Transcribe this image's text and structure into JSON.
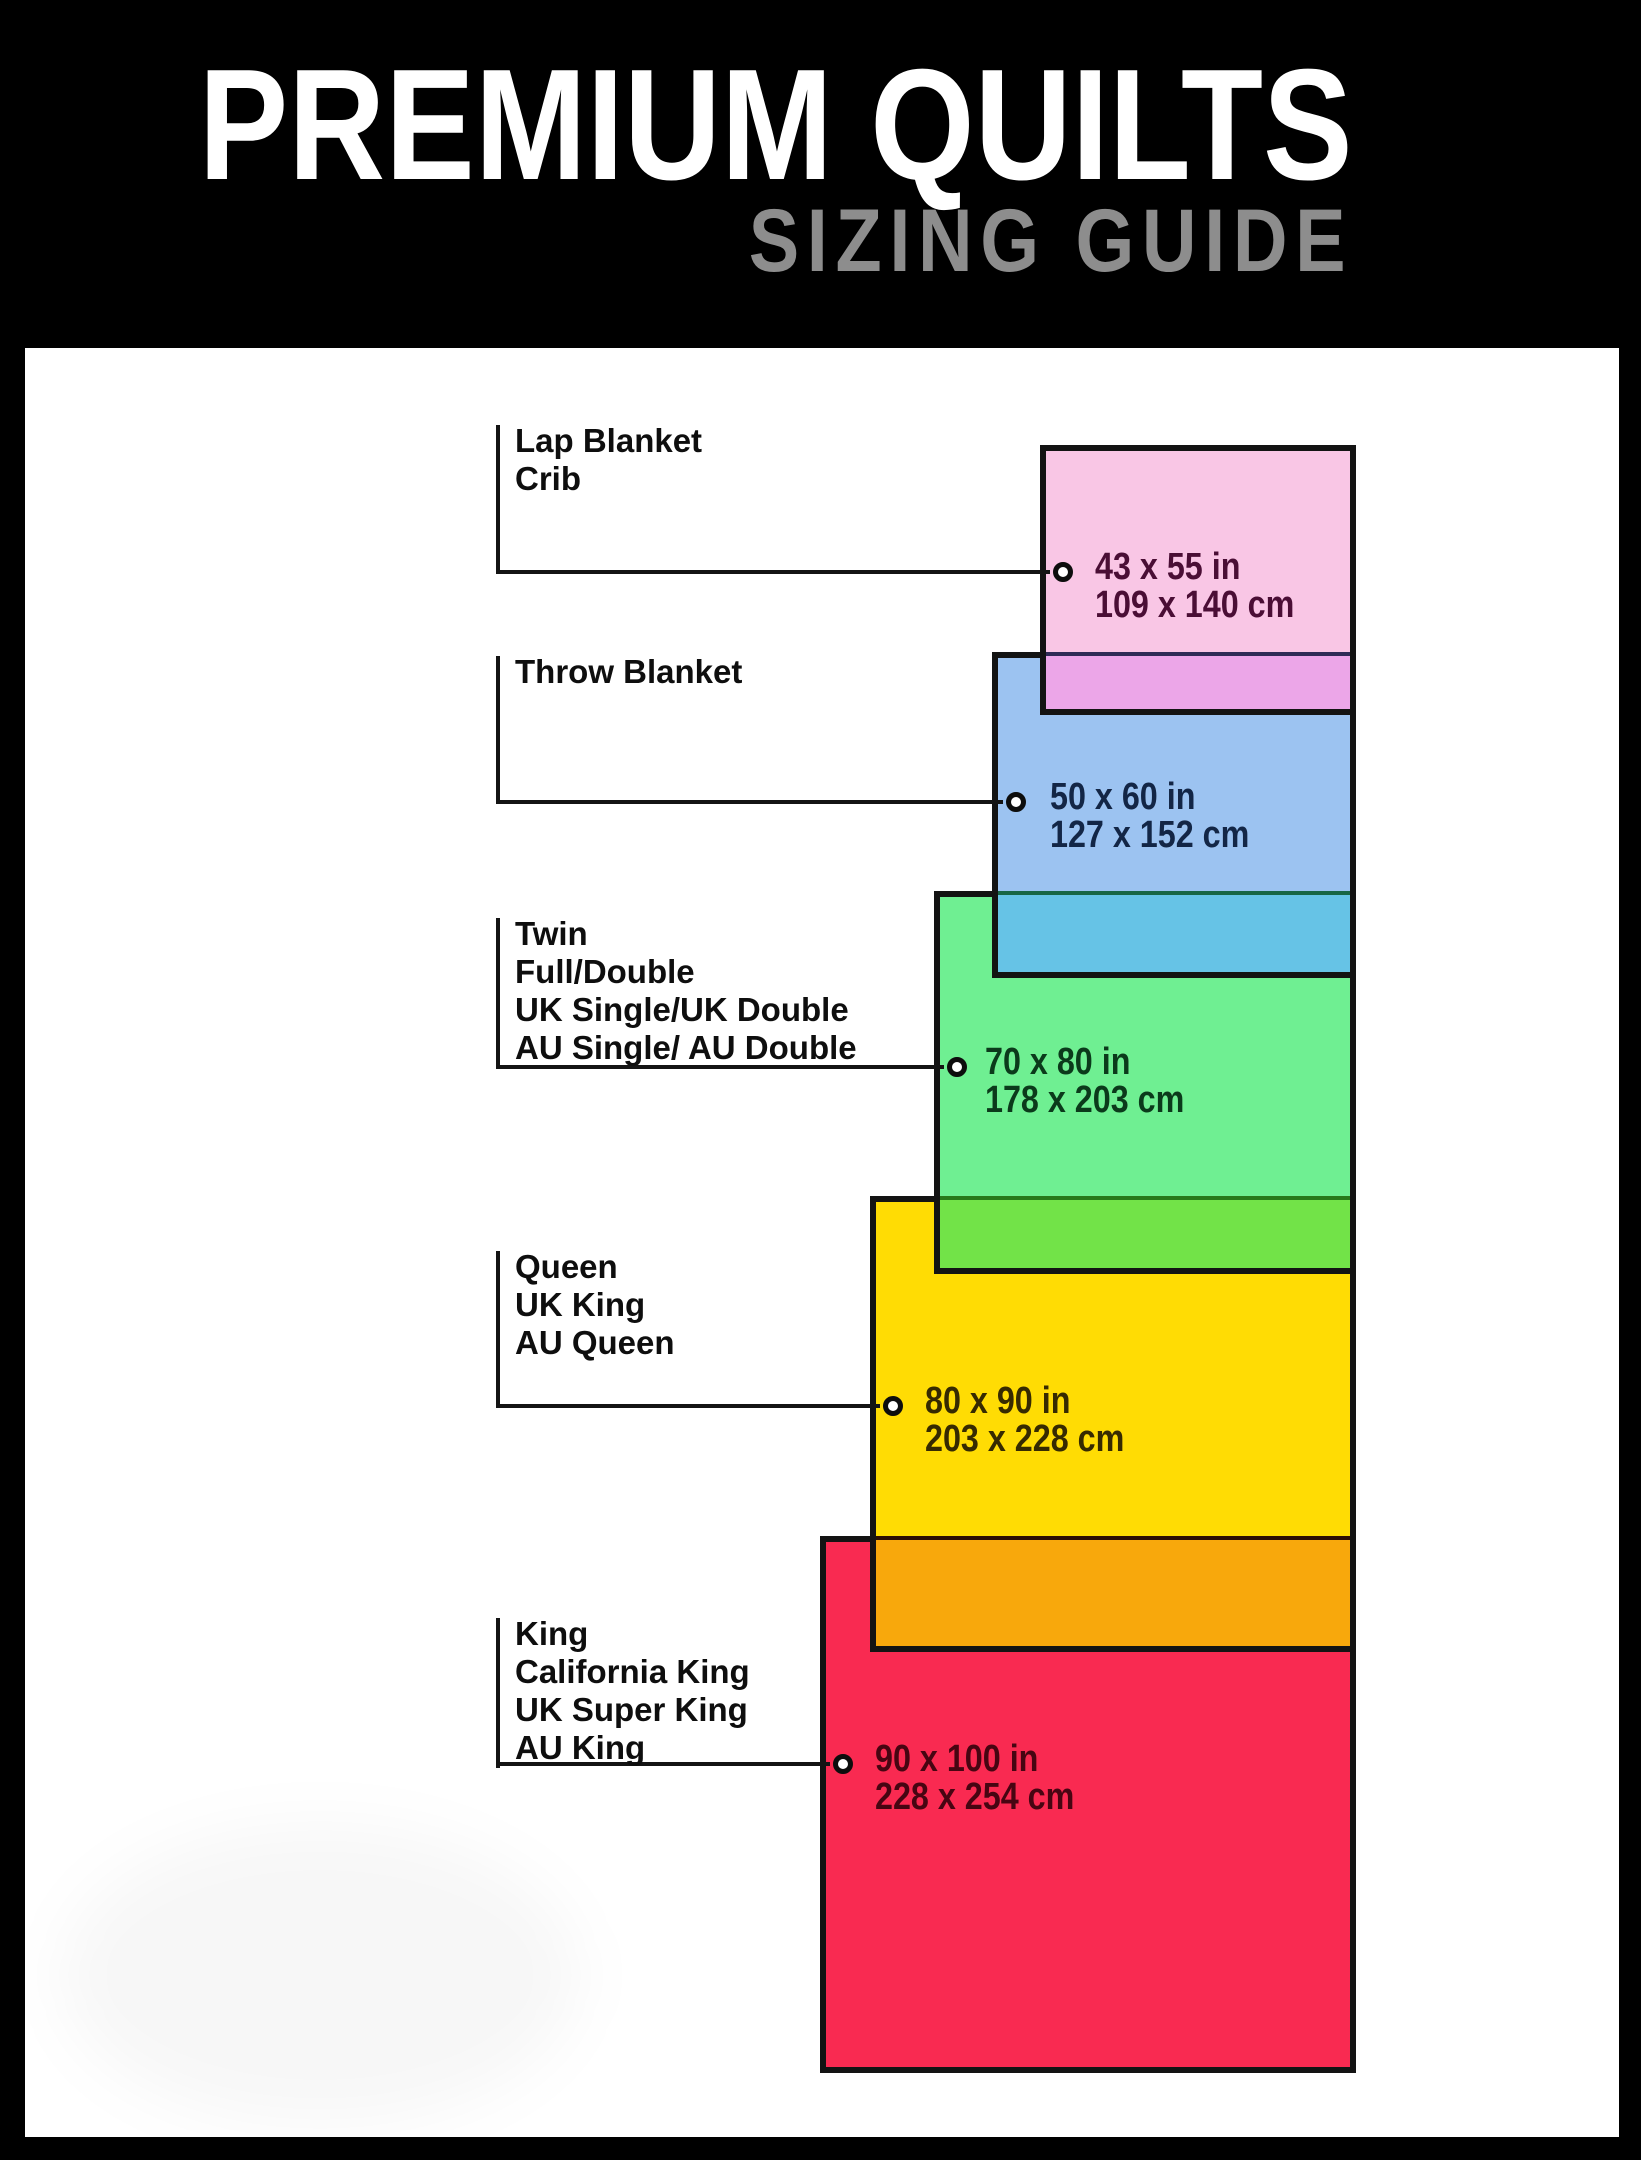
{
  "page": {
    "title": "PREMIUM QUILTS",
    "subtitle": "SIZING GUIDE",
    "background_color": "#000000",
    "panel_color": "#ffffff",
    "title_color": "#ffffff",
    "subtitle_color": "#8d8d8d",
    "line_color": "#141414",
    "rect_border_color": "#131313"
  },
  "sizes": [
    {
      "id": "lap-crib",
      "labels": [
        "Lap Blanket",
        "Crib"
      ],
      "inches": "43 x 55 in",
      "cm": "109 x 140 cm",
      "fill": "#F9C6E5",
      "overlap_fill": "#ECA6E8",
      "overlap_line": "#2F2B56",
      "text_color": "#4A0E35"
    },
    {
      "id": "throw",
      "labels": [
        "Throw Blanket"
      ],
      "inches": "50 x 60 in",
      "cm": "127 x 152 cm",
      "fill": "#9CC3F1",
      "overlap_fill": "#66C3E6",
      "overlap_line": "#176645",
      "text_color": "#132646"
    },
    {
      "id": "twin-full",
      "labels": [
        "Twin",
        "Full/Double",
        "UK Single/UK Double",
        "AU Single/ AU Double"
      ],
      "inches": "70 x 80 in",
      "cm": "178 x 203 cm",
      "fill": "#6FEF92",
      "overlap_fill": "#72E348",
      "overlap_line": "#27791B",
      "text_color": "#0B3A1B"
    },
    {
      "id": "queen",
      "labels": [
        "Queen",
        "UK King",
        "AU Queen"
      ],
      "inches": "80 x 90 in",
      "cm": "203 x 228 cm",
      "fill": "#FFDC04",
      "overlap_fill": "#F8A80C",
      "overlap_line": "#2B0E04",
      "text_color": "#362A01"
    },
    {
      "id": "king",
      "labels": [
        "King",
        "California King",
        "UK Super King",
        "AU King"
      ],
      "inches": "90 x 100 in",
      "cm": "228 x 254 cm",
      "fill": "#F92A51",
      "overlap_fill": "",
      "overlap_line": "",
      "text_color": "#470512"
    }
  ]
}
